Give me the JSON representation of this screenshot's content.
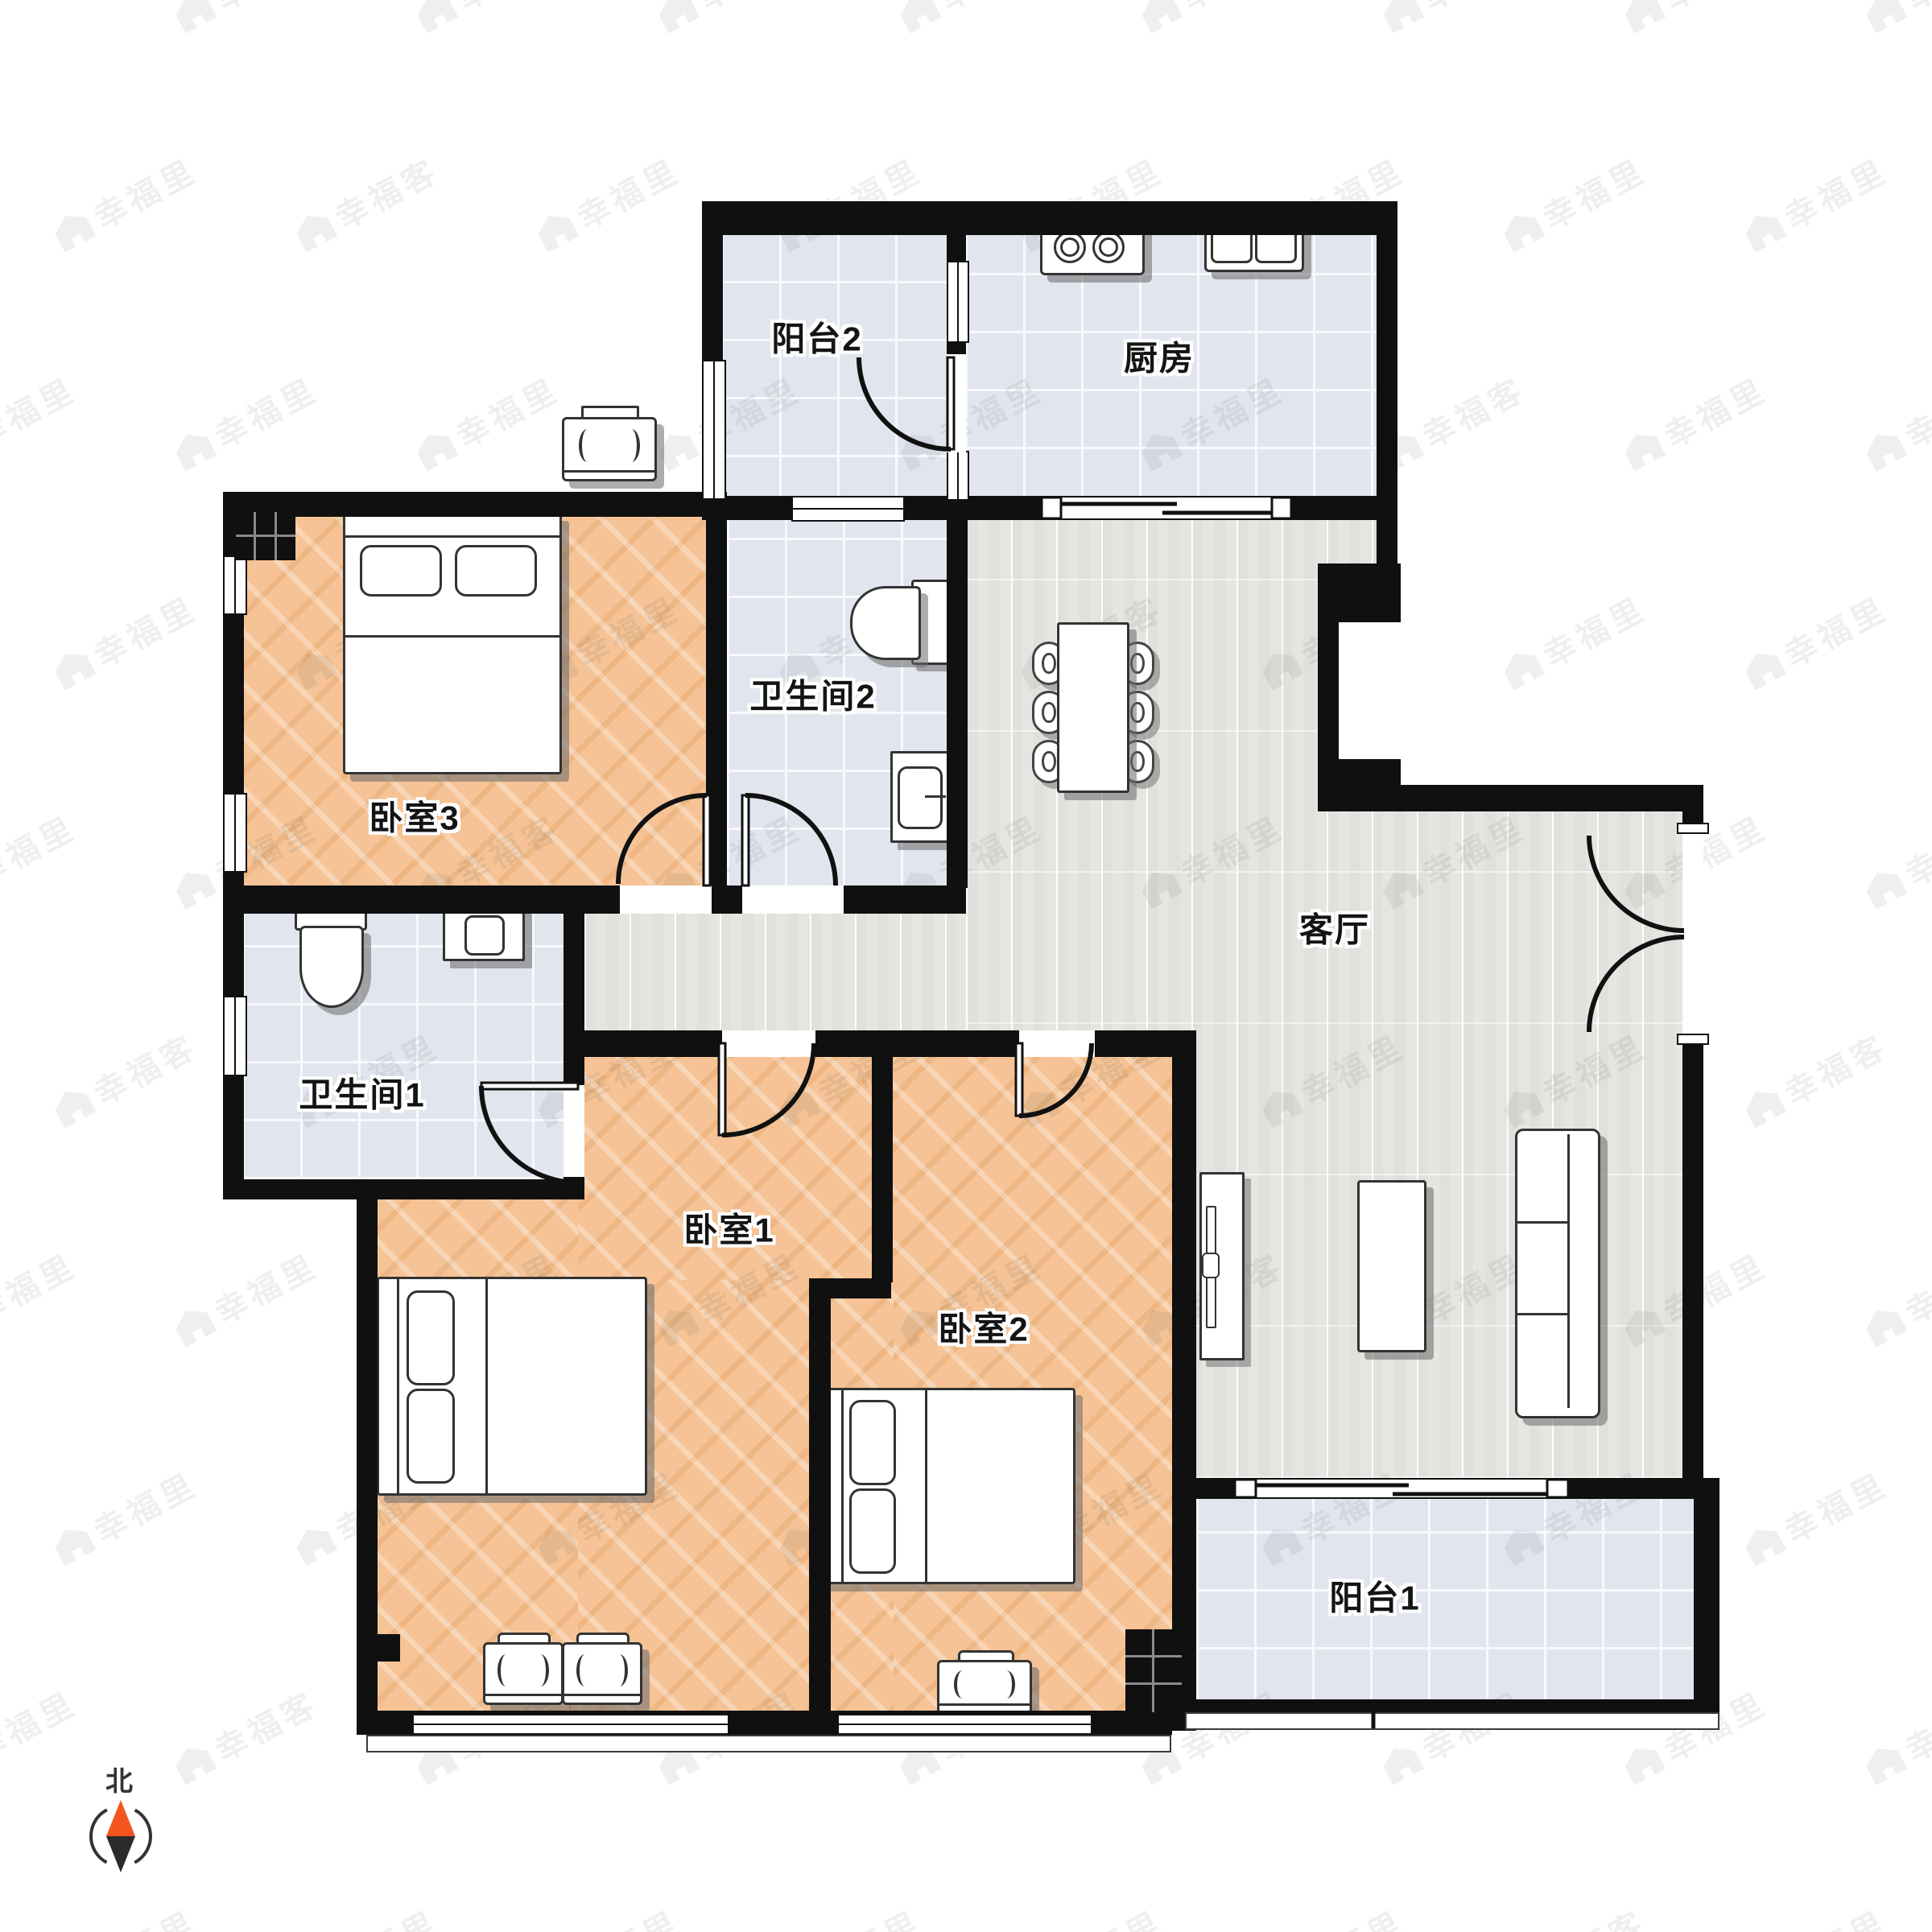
{
  "floorplan": {
    "rooms": [
      {
        "id": "balcony-2",
        "label": "阳台2",
        "floor": "tile"
      },
      {
        "id": "kitchen",
        "label": "厨房",
        "floor": "tile"
      },
      {
        "id": "bedroom-3",
        "label": "卧室3",
        "floor": "wood"
      },
      {
        "id": "bathroom-2",
        "label": "卫生间2",
        "floor": "tile"
      },
      {
        "id": "living-room",
        "label": "客厅",
        "floor": "plank"
      },
      {
        "id": "bathroom-1",
        "label": "卫生间1",
        "floor": "tile"
      },
      {
        "id": "bedroom-1",
        "label": "卧室1",
        "floor": "wood"
      },
      {
        "id": "bedroom-2",
        "label": "卧室2",
        "floor": "wood"
      },
      {
        "id": "balcony-1",
        "label": "阳台1",
        "floor": "tile"
      }
    ],
    "compass": {
      "label": "北",
      "needle_up_color": "#f4551e",
      "needle_down_color": "#2b2b2b"
    },
    "watermark": {
      "texts": [
        "幸福里",
        "幸福客"
      ]
    },
    "colors": {
      "wall": "#101010",
      "wood": "#f5c395",
      "plank": "#e7e5e1",
      "tile": "#e1e5ee",
      "north": "#f4551e"
    }
  }
}
